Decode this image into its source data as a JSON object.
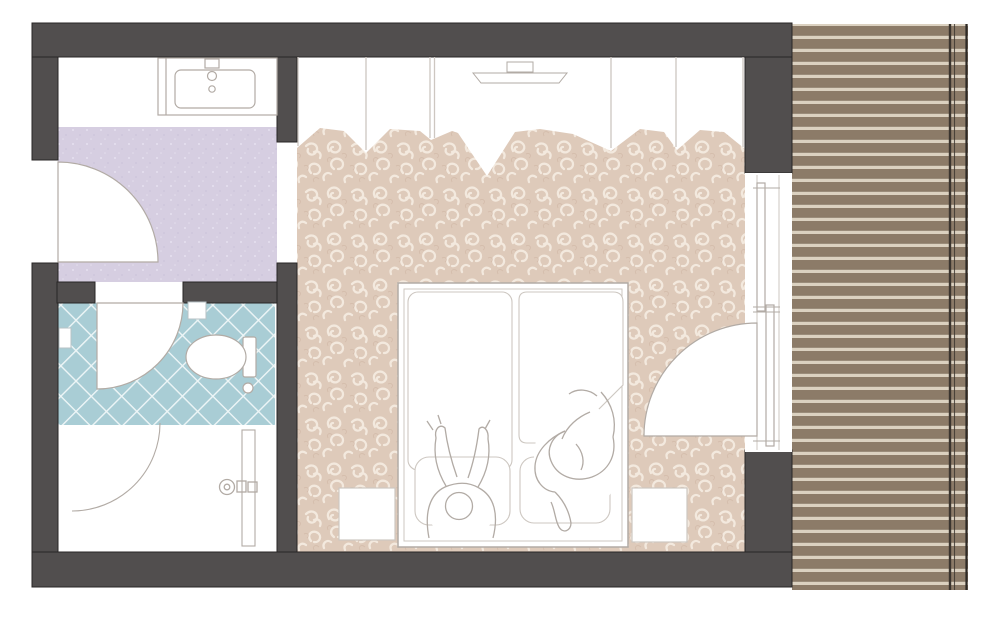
{
  "document": {
    "kind": "hotel-room-floor-plan",
    "view": "top-down-architectural-drawing",
    "visible_text": ""
  },
  "colors": {
    "background": "#ffffff",
    "wall": "#514e4e",
    "wall_outline": "#282525",
    "lavender_floor": "#d6cee1",
    "lavender_dot_light": "#e4deed",
    "lavender_dot_dark": "#c8bfd8",
    "tile_base": "#a9cdd5",
    "tile_line": "#eef6f7",
    "carpet_base": "#decaba",
    "carpet_swirl": "#f3e9de",
    "carpet_swirl_dark": "#cbb19f",
    "deck_plank": "#8c7b68",
    "deck_gap": "#dbd1c0",
    "deck_rail": "#3a342e",
    "deck_edge": "#2d2926",
    "furniture_line": "#b2aba5",
    "furniture_line_light": "#cdc7c1",
    "fixture_line": "#b7c2c5",
    "white": "#ffffff"
  },
  "rooms": [
    {
      "id": "entry-vanity-area",
      "floor": "lavender"
    },
    {
      "id": "bathroom",
      "floor": "blue-diamond-tile"
    },
    {
      "id": "bedroom",
      "floor": "swirl-carpet"
    },
    {
      "id": "balcony",
      "floor": "wood-plank-deck"
    }
  ],
  "fixtures": [
    "washbasin-counter",
    "faucet",
    "entry-door-swing",
    "bathroom-door-swing",
    "shower-door-swing",
    "shower-niche",
    "wall-niche",
    "toilet",
    "toilet-roll-holder",
    "storage-panel-door",
    "door-handle",
    "wardrobe-row",
    "tv-console",
    "double-bed",
    "duvet-left",
    "duvet-right",
    "pillow-left",
    "pillow-right",
    "sleeping-figure-left",
    "sleeping-figure-right",
    "nightstand-left",
    "nightstand-right",
    "sliding-window-panel-upper",
    "sliding-window-panel-lower",
    "balcony-door-swing",
    "deck-railing"
  ]
}
